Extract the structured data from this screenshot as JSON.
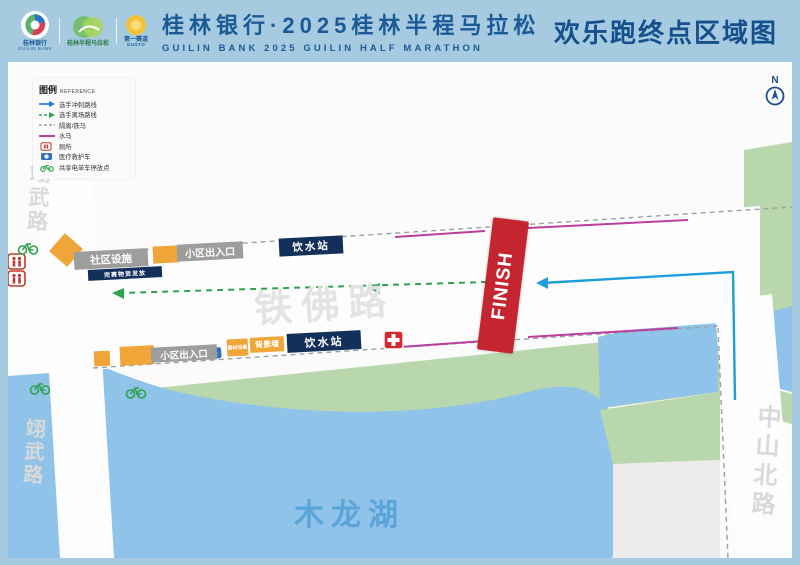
{
  "header": {
    "bank_logo": {
      "cn": "桂林银行",
      "en": "GUILIN BANK"
    },
    "marathon_logo": {
      "cn": "桂林半程马拉松"
    },
    "gusto_logo": {
      "cn": "第一赛道",
      "en": "GUSTO"
    },
    "title_cn": "桂林银行·2025桂林半程马拉松",
    "title_en": "GUILIN BANK 2025 GUILIN HALF MARATHON",
    "right_title": "欢乐跑终点区域图"
  },
  "legend": {
    "title_cn": "图例",
    "title_en": "REFERENCE",
    "items": [
      {
        "icon": "sprint-route-arrow",
        "label": "选手冲刺路线"
      },
      {
        "icon": "exit-route-arrow",
        "label": "选手离场路线"
      },
      {
        "icon": "barrier-dashed-line",
        "label": "隔离/铁马"
      },
      {
        "icon": "water-barrier-line",
        "label": "水马"
      },
      {
        "icon": "toilet",
        "label": "厕所"
      },
      {
        "icon": "ambulance",
        "label": "医疗救护车"
      },
      {
        "icon": "shared-ebike",
        "label": "共享电单车停放点"
      }
    ]
  },
  "map": {
    "north_label": "N",
    "finish_label": "FINISH",
    "roads": {
      "left_top": "翊武路",
      "left_bottom": "翊武路",
      "center": "铁佛路",
      "right": "中山北路"
    },
    "lake_label": "木龙湖",
    "facilities": {
      "community": "社区设施",
      "community_sub": "完赛物资发放",
      "gate_top": "小区出入口",
      "water_station_top": "饮水站",
      "gate_bottom": "小区出入口",
      "equipment_sign": "器材设备",
      "backdrop_wall": "背景墙",
      "water_station_bottom": "饮水站"
    }
  },
  "colors": {
    "header_bg": "#a6cbe1",
    "title_blue": "#1b5a96",
    "finish_red": "#c4252e",
    "lake_blue": "#8fc3ea",
    "park_green": "#b9d7ac",
    "sprint_route_cyan": "#1f9fd8",
    "exit_route_green": "#2fa24e",
    "water_barrier_magenta": "#bb3f9e",
    "box_navy": "#13305a",
    "box_gray": "#9d9d9d",
    "box_yellow": "#f0a538"
  }
}
